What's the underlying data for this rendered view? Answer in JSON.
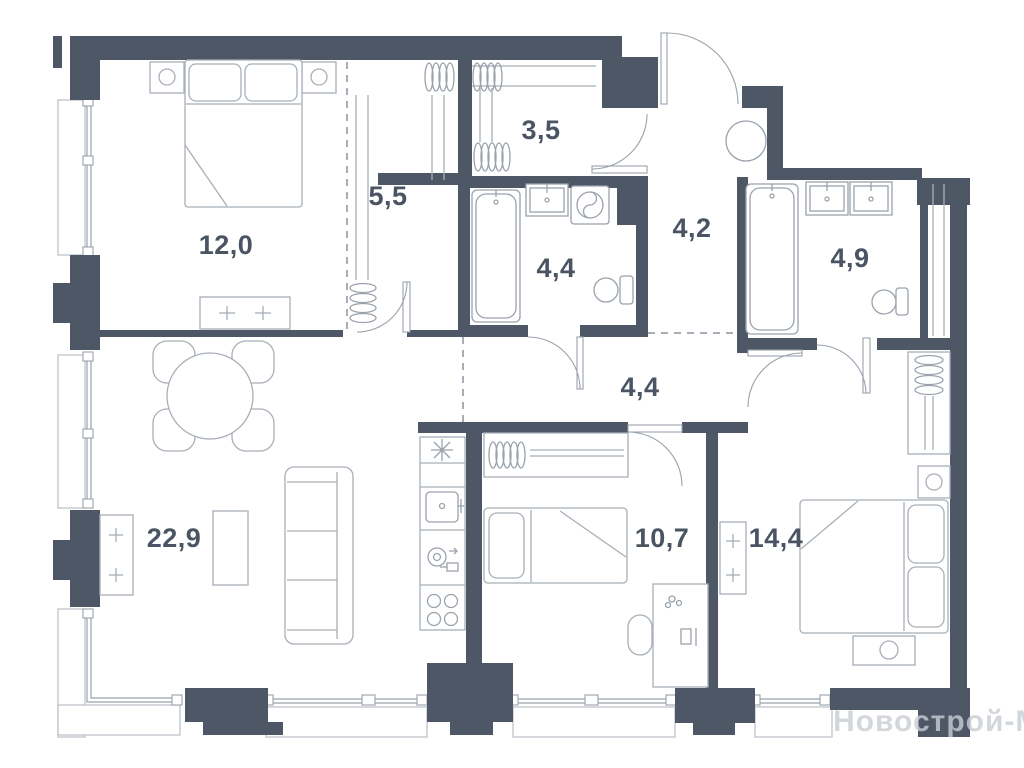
{
  "document": {
    "kind": "apartment-floor-plan",
    "language": "ru",
    "units": "m2"
  },
  "watermark": {
    "text": "Новострой-М"
  },
  "colors": {
    "background": "#ffffff",
    "wall": "#4d5765",
    "line": "#a8afb8",
    "fixture": "#9aa2ac",
    "sill": "#b9bfc6",
    "dashed": "#8a93a0",
    "label": "#4a5463",
    "watermark": "#c9ced3"
  },
  "rooms": [
    {
      "name": "bedroom-1",
      "area_label": "12,0"
    },
    {
      "name": "wardrobe",
      "area_label": "5,5"
    },
    {
      "name": "storage-closet",
      "area_label": "3,5"
    },
    {
      "name": "bathroom-1",
      "area_label": "4,4"
    },
    {
      "name": "entry-hall",
      "area_label": "4,2"
    },
    {
      "name": "bathroom-2",
      "area_label": "4,9"
    },
    {
      "name": "hallway",
      "area_label": "4,4"
    },
    {
      "name": "living-kitchen",
      "area_label": "22,9"
    },
    {
      "name": "bedroom-2",
      "area_label": "10,7"
    },
    {
      "name": "bedroom-3",
      "area_label": "14,4"
    }
  ]
}
